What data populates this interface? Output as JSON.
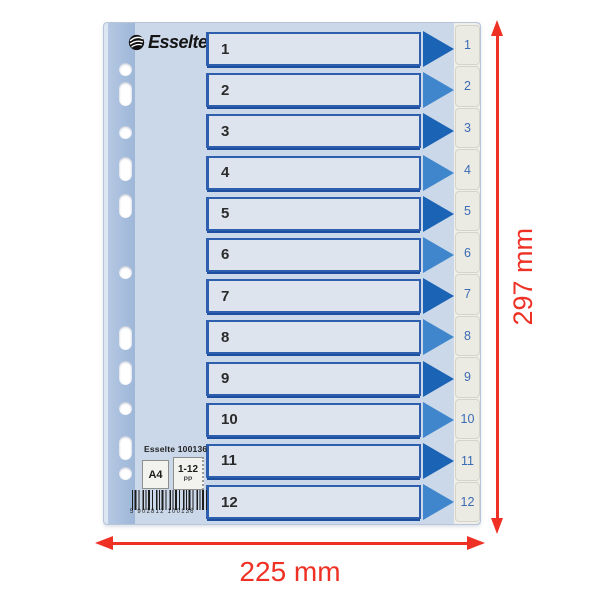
{
  "brand": {
    "name": "Esselte"
  },
  "rows": [
    "1",
    "2",
    "3",
    "4",
    "5",
    "6",
    "7",
    "8",
    "9",
    "10",
    "11",
    "12"
  ],
  "dimensions": {
    "height": "297 mm",
    "width": "225 mm"
  },
  "label_plate": {
    "title": "Esselte 100136",
    "format": "A4",
    "range": "1-12",
    "material": "PP",
    "barcode_text": "5 902812 100136"
  },
  "icons": {
    "logo_mark": "esselte-swirl",
    "row_arrow": "right-triangle",
    "dimension_arrows": "red-double-headed"
  },
  "colors": {
    "accent_red": "#ee3124",
    "sheet": "#cbd8e9",
    "punch_band": "#a7bedd",
    "box_fill": "#dde4ee",
    "box_border": "#2d5fae",
    "triangle_dark": "#1a63b5",
    "triangle_light": "#3f86cd",
    "tab_bg": "#ebeae3",
    "tab_text": "#3c6cb4"
  }
}
